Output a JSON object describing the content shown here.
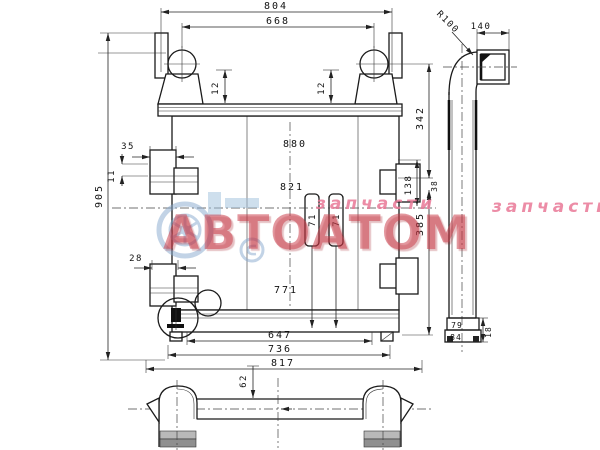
{
  "dims": {
    "w804": "804",
    "w668": "668",
    "h12l": "12",
    "h12r": "12",
    "h905": "905",
    "b35": "35",
    "b11": "11",
    "b28": "28",
    "r342": "342",
    "r38": "38",
    "r138": "138",
    "r385": "385",
    "c880": "880",
    "c821": "821",
    "c771": "771",
    "p71l": "71",
    "p71r": "71",
    "w647": "647",
    "w736": "736",
    "w817": "817",
    "v62": "62",
    "s140": "140",
    "sR100": "R100",
    "s79": "79",
    "s84": "84",
    "s18": "18"
  },
  "watermark": {
    "brand": "АВТОАТОМ",
    "caption": "запчасти",
    "caption2": "запчасти",
    "brand_color": "#c93a46",
    "accent_color": "#86a9cf"
  }
}
